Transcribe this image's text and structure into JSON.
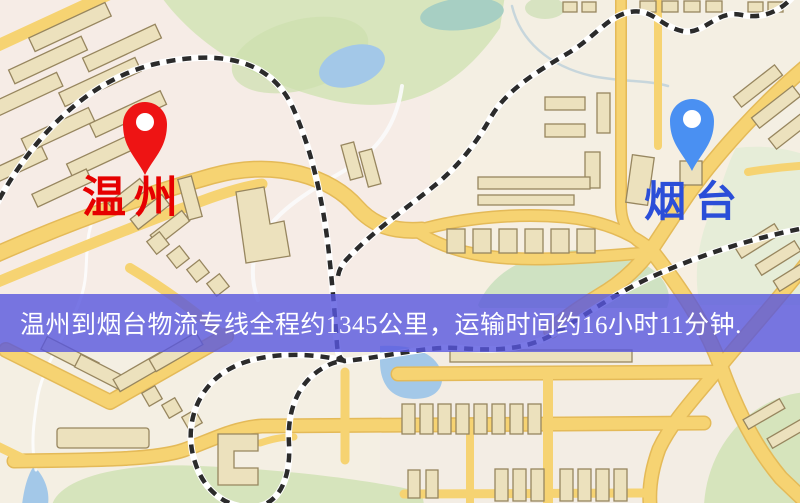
{
  "map": {
    "origin_marker": {
      "label": "温州",
      "pin_color": "#ee1414",
      "label_color": "#e60000"
    },
    "destination_marker": {
      "label": "烟台",
      "pin_color": "#4a90f2",
      "label_color": "#2b4ed8"
    },
    "banner": {
      "text": "温州到烟台物流专线全程约1345公里，运输时间约16小时11分钟.",
      "bg_color": "rgba(88,86,222,0.8)",
      "text_color": "#ffffff"
    },
    "palette": {
      "background": "#f4efe3",
      "road": "#f6d372",
      "road_casing": "#e4ba58",
      "building": "#ece1bd",
      "building_outline": "#97865f",
      "park_green": "#d8e5bd",
      "water_blue": "#a3c8e8",
      "railway_black": "#2b2b2b",
      "railway_white": "#ffffff"
    },
    "icons": {
      "origin_pin": "map-pin-icon",
      "destination_pin": "map-pin-icon"
    }
  }
}
